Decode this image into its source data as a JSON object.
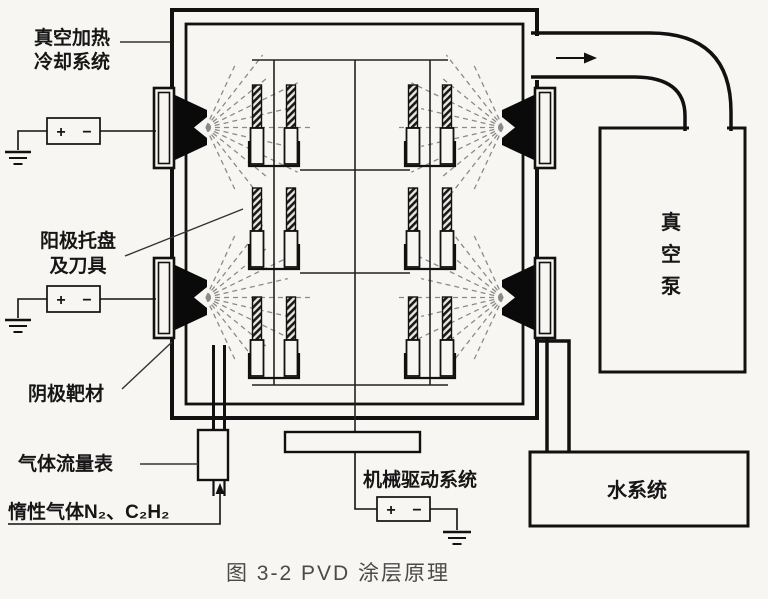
{
  "figure": {
    "caption": "图 3-2  PVD 涂层原理"
  },
  "labels": {
    "vacuum_heating": {
      "line1": "真空加热",
      "line2": "冷却系统"
    },
    "anode_tray": {
      "line1": "阳极托盘",
      "line2": "及刀具"
    },
    "cathode_target": "阴极靶材",
    "gas_flow_meter": "气体流量表",
    "inert_gas": "惰性气体N₂、C₂H₂",
    "mechanical_drive": "机械驱动系统",
    "vacuum_pump": {
      "full": "真空泵",
      "chars": [
        "真",
        "空",
        "泵"
      ]
    },
    "water_system": "水系统"
  },
  "symbols": {
    "plus": "+",
    "minus": "−"
  },
  "colors": {
    "line": "#111111",
    "target_fill": "#0a0a0a",
    "background": "#f7f6f2",
    "caption": "#4a4a4a"
  }
}
